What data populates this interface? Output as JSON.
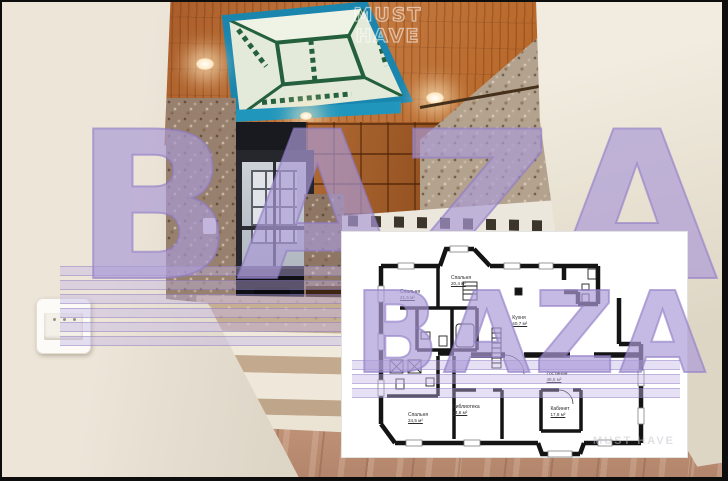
{
  "watermarks": {
    "brand": "BAZA",
    "must_have_line1": "MUST",
    "must_have_line2": "HAVE",
    "plan_corner_brand": "MUST HAVE"
  },
  "floor_plan": {
    "rooms": [
      {
        "name": "Спальня",
        "area": "21,5 м²"
      },
      {
        "name": "Спальня",
        "area": "20,4 м²"
      },
      {
        "name": "Кухня",
        "area": "40,7 м²"
      },
      {
        "name": "Гостиная",
        "area": "48,5 м²"
      },
      {
        "name": "Спальня",
        "area": "24,5 м²"
      },
      {
        "name": "Библиотека",
        "area": "14,6 м²"
      },
      {
        "name": "Кабинет",
        "area": "17,8 м²"
      }
    ]
  },
  "colors": {
    "watermark_lavender": "#b8aade",
    "watermark_outline": "#8f7bc6",
    "skylight_frame_teal": "#1a86ae",
    "skylight_lattice_green": "#24603c",
    "ceiling_wood": "#b5642b",
    "wall_cream": "#e7e0d2",
    "stone_texture": "#97816e",
    "plan_wall": "#141414",
    "frame_black": "#0d0d0d"
  }
}
